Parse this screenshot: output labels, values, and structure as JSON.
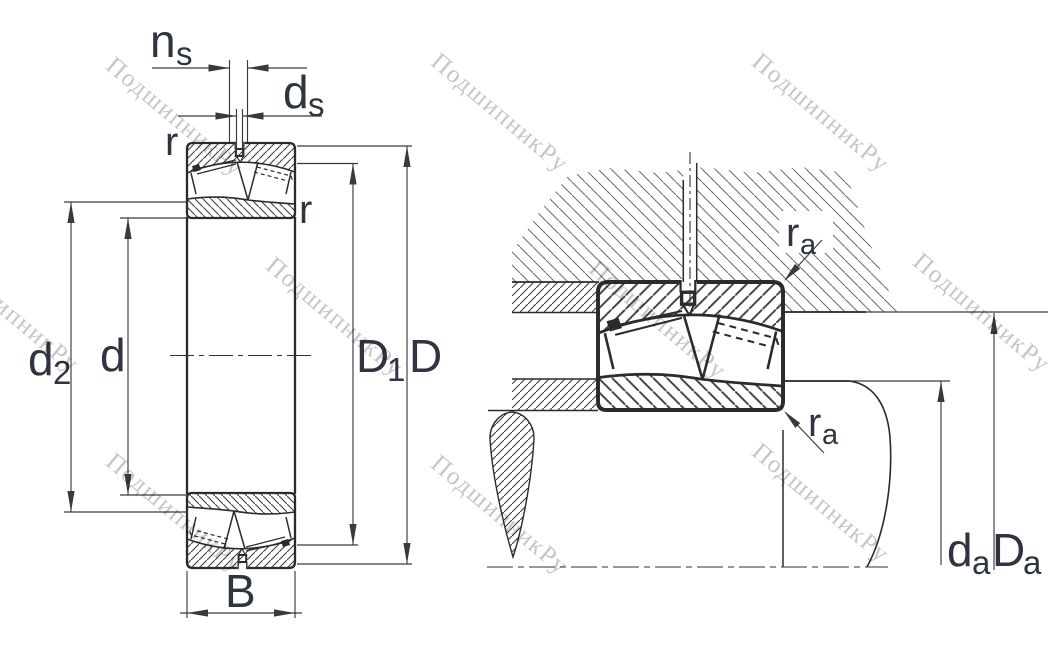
{
  "watermark": {
    "text": "ПодшипникРу"
  },
  "drawing": {
    "left_view": {
      "dims": {
        "ns": {
          "main": "n",
          "sub": "s"
        },
        "ds": {
          "main": "d",
          "sub": "s"
        },
        "r_top": {
          "main": "r",
          "sub": ""
        },
        "r_side": {
          "main": "r",
          "sub": ""
        },
        "d2": {
          "main": "d",
          "sub": "2"
        },
        "d": {
          "main": "d",
          "sub": ""
        },
        "D1": {
          "main": "D",
          "sub": "1"
        },
        "D": {
          "main": "D",
          "sub": ""
        },
        "B": {
          "main": "B",
          "sub": ""
        }
      }
    },
    "right_view": {
      "dims": {
        "ra_top": {
          "main": "r",
          "sub": "a"
        },
        "ra_bottom": {
          "main": "r",
          "sub": "a"
        },
        "da": {
          "main": "d",
          "sub": "a"
        },
        "Da": {
          "main": "D",
          "sub": "a"
        }
      }
    }
  },
  "colors": {
    "background": "#ffffff",
    "line": "#2b2b2b",
    "dimension": "#3a3a3a",
    "label_text": "#2e3540",
    "watermark": "#c6c6c6"
  }
}
